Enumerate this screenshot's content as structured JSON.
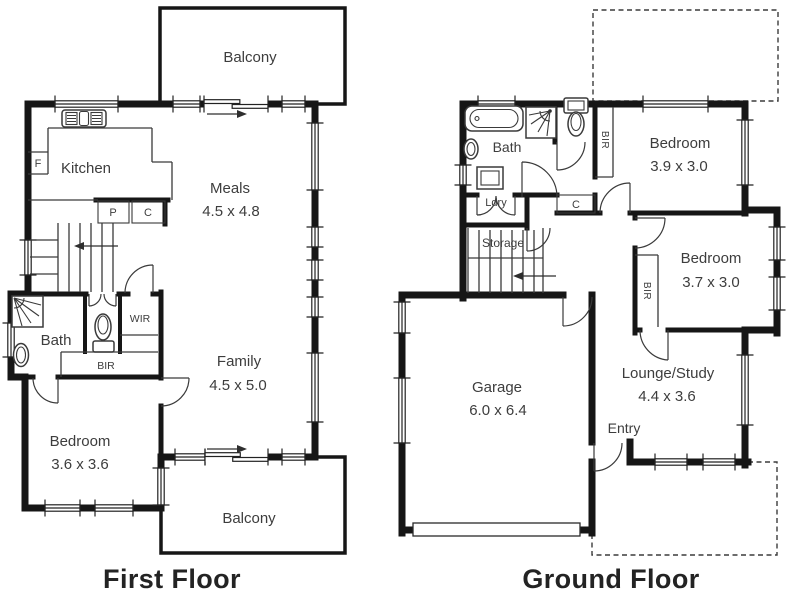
{
  "titles": {
    "first": "First Floor",
    "ground": "Ground Floor"
  },
  "first_floor": {
    "balcony_top": "Balcony",
    "balcony_bottom": "Balcony",
    "kitchen": "Kitchen",
    "fridge": "F",
    "pantry": "P",
    "cupboard": "C",
    "meals_name": "Meals",
    "meals_dims": "4.5 x 4.8",
    "family_name": "Family",
    "family_dims": "4.5 x 5.0",
    "bedroom_name": "Bedroom",
    "bedroom_dims": "3.6 x 3.6",
    "bath": "Bath",
    "wir": "WIR",
    "bir": "BIR"
  },
  "ground_floor": {
    "bath": "Bath",
    "laundry": "Ldry",
    "storage": "Storage",
    "cupboard": "C",
    "entry": "Entry",
    "bedroom1_name": "Bedroom",
    "bedroom1_dims": "3.9 x 3.0",
    "bedroom2_name": "Bedroom",
    "bedroom2_dims": "3.7 x 3.0",
    "bir1": "BIR",
    "bir2": "BIR",
    "lounge_name": "Lounge/Study",
    "lounge_dims": "4.4 x 3.6",
    "garage_name": "Garage",
    "garage_dims": "6.0 x 6.4"
  },
  "colors": {
    "wall": "#161616",
    "line": "#3a3a3a",
    "label_text": "#3d3d3d",
    "title_text": "#232323",
    "background": "#ffffff"
  }
}
